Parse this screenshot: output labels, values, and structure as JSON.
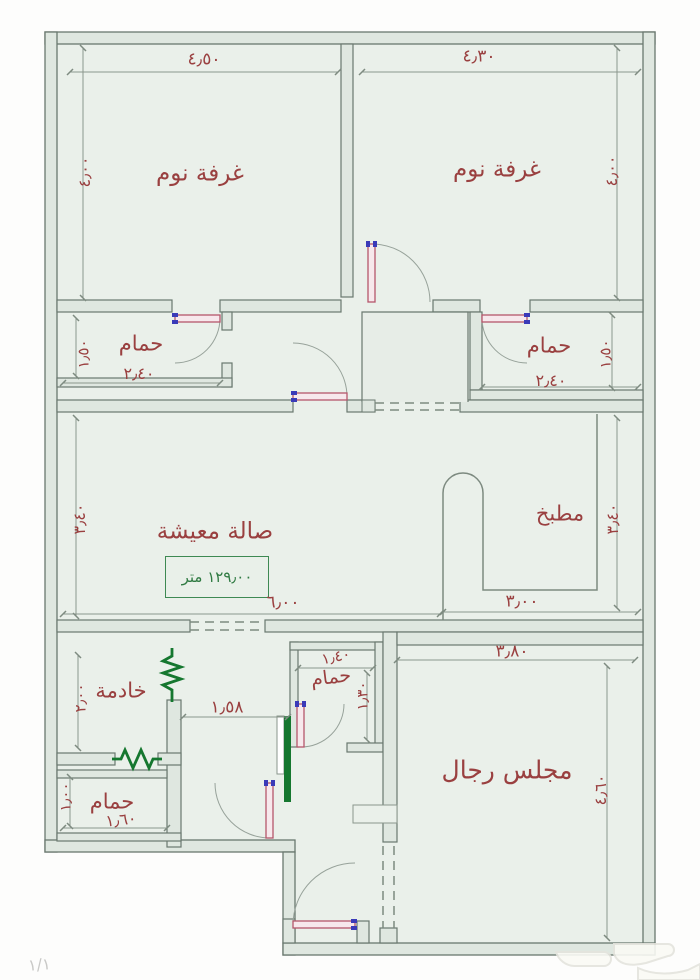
{
  "document": {
    "type": "apartment-floor-plan",
    "language": "arabic",
    "page": {
      "marker": "١/١"
    }
  },
  "rooms": {
    "bedroom_left": {
      "label": "غرفة نوم"
    },
    "bedroom_right": {
      "label": "غرفة نوم"
    },
    "bath_top_left": {
      "label": "حمام"
    },
    "bath_top_right": {
      "label": "حمام"
    },
    "living": {
      "label": "صالة معيشة"
    },
    "kitchen": {
      "label": "مطبخ"
    },
    "maid": {
      "label": "خادمة"
    },
    "bath_middle": {
      "label": "حمام"
    },
    "bath_bottom": {
      "label": "حمام"
    },
    "majlis": {
      "label": "مجلس رجال"
    }
  },
  "area_box": {
    "value": "١٢٩٫٠٠ متر"
  },
  "dims": {
    "bedroom_left_width": "٤٫٥٠",
    "bedroom_right_width": "٤٫٣٠",
    "bedroom_left_height": "٤٫٠٠",
    "bedroom_right_height": "٤٫٠٠",
    "bath_top_left_width": "٢٫٤٠",
    "bath_top_left_height": "١٫٥٠",
    "bath_top_right_width": "٢٫٤٠",
    "bath_top_right_height": "١٫٥٠",
    "living_width": "٦٫٠٠",
    "living_height": "٣٫٤٠",
    "kitchen_width": "٣٫٠٠",
    "kitchen_height": "٣٫٤٠",
    "corridor_width": "١٫٥٨",
    "bath_middle_width": "١٫٤٠",
    "bath_middle_height": "١٫٣٠",
    "maid_height": "٢٫٠٠",
    "bath_bottom_width": "١٫٦٠",
    "bath_bottom_height": "١٫٠٠",
    "majlis_width": "٣٫٨٠",
    "majlis_height": "٤٫٦٠"
  },
  "colors": {
    "label_text": "#9a4040",
    "wall_line": "#6a786f",
    "floor_fill": "#eaf0ea",
    "green_annotation": "#15772f",
    "area_text": "#2f7a42",
    "door_leaf": "#b5566b",
    "door_hinge": "#3a3ab8"
  }
}
